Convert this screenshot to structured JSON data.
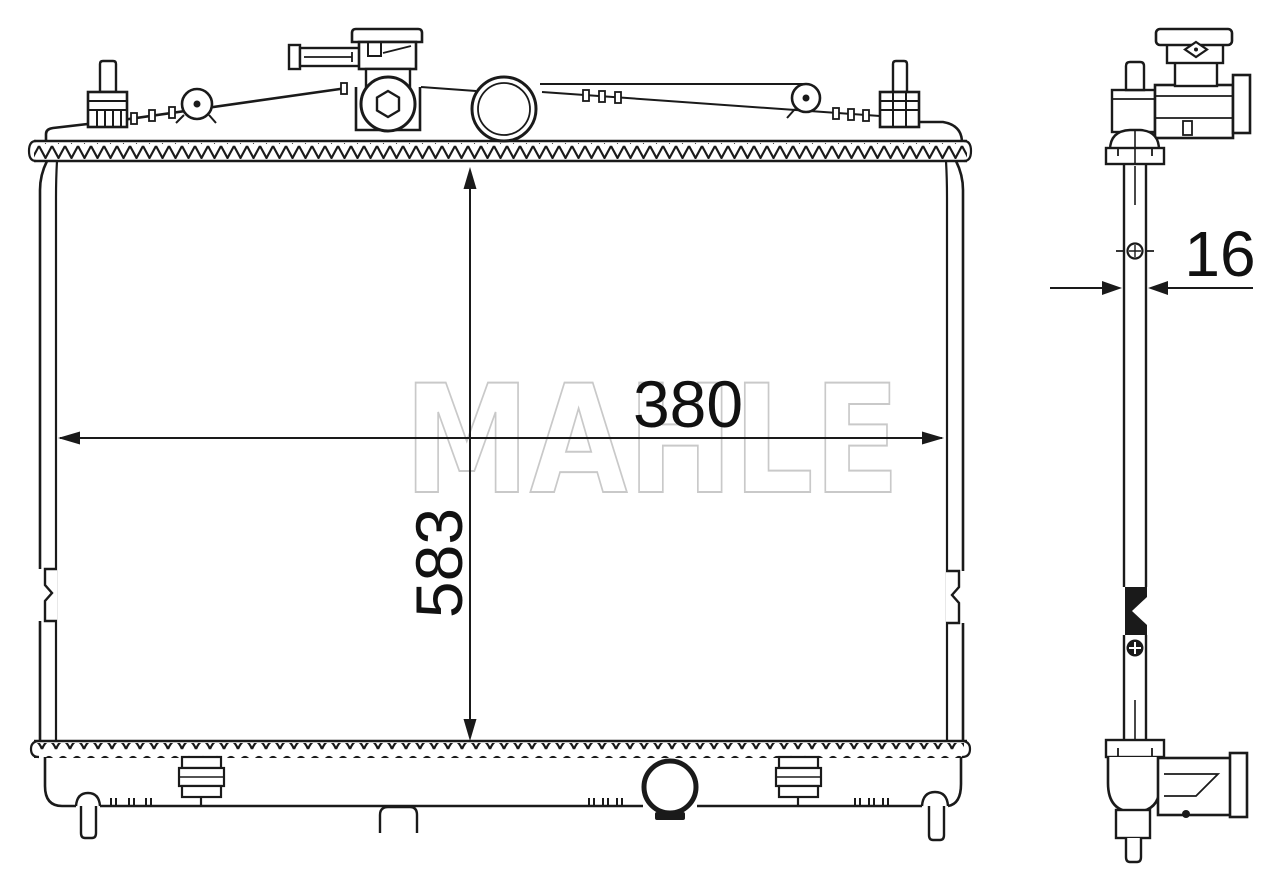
{
  "watermark": {
    "text": "MAHLE",
    "color": "#c9c9c9"
  },
  "dimensions": {
    "width": "380",
    "height": "583",
    "thickness": "16"
  },
  "colors": {
    "line": "#1a1a1a",
    "background": "#ffffff",
    "watermark": "#c9c9c9"
  }
}
